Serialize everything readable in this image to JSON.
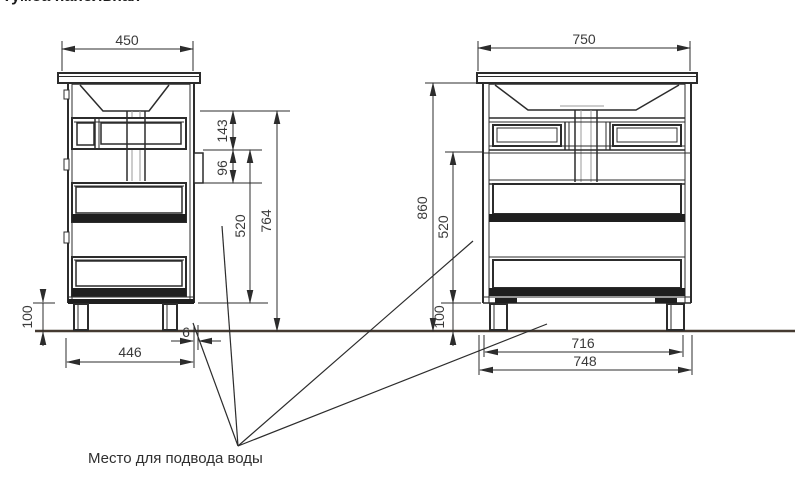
{
  "page": {
    "title_partial": "Тумба напольная",
    "background": "#ffffff"
  },
  "drawing": {
    "type": "technical-drawing",
    "caption": "Место для подвода воды",
    "colors": {
      "line": "#2c2c2c",
      "floor_line": "#453a31",
      "dim_text": "#3a3a3a",
      "drawer_band": "#1f1f1f"
    },
    "side_view": {
      "name": "side view",
      "dimensions": {
        "top_width_mm": "450",
        "sink_zone_height_mm": "143",
        "bracket_height_mm": "96",
        "drawer_zone_height_mm": "520",
        "body_height_mm": "764",
        "leg_height_mm": "100",
        "bottom_depth_mm": "446",
        "back_gap_mm": "6"
      }
    },
    "front_view": {
      "name": "front view",
      "dimensions": {
        "top_width_mm": "750",
        "total_height_mm": "860",
        "drawer_zone_height_mm": "520",
        "leg_height_mm": "100",
        "inner_width_mm": "716",
        "outer_width_mm": "748"
      }
    }
  }
}
